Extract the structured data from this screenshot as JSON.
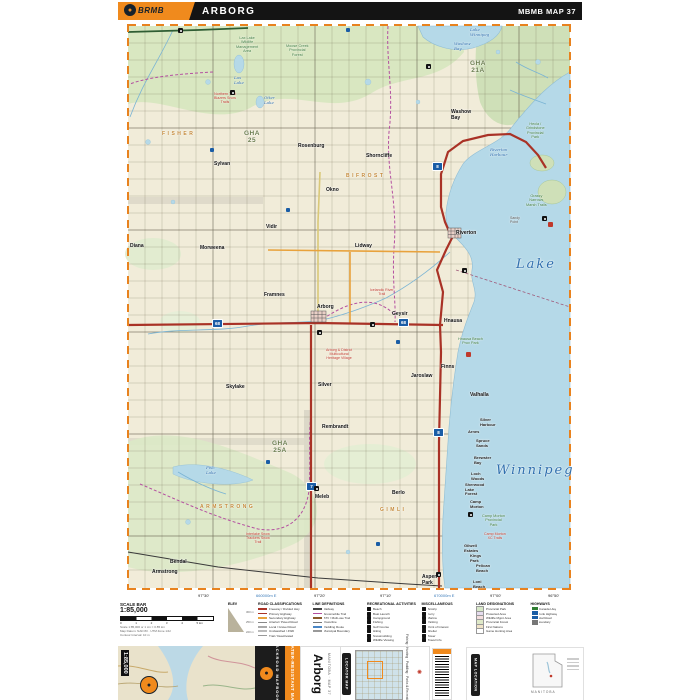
{
  "header": {
    "brand": "BRMB",
    "title": "ARBORG",
    "ref": "MBMB MAP 37"
  },
  "map": {
    "labels": [
      {
        "t": "Sylvan",
        "x": 96,
        "y": 140,
        "c": "town"
      },
      {
        "t": "Rosenburg",
        "x": 180,
        "y": 122,
        "c": "town"
      },
      {
        "t": "Shorncliffe",
        "x": 248,
        "y": 132,
        "c": "town"
      },
      {
        "t": "Okno",
        "x": 208,
        "y": 166,
        "c": "town"
      },
      {
        "t": "Vidir",
        "x": 148,
        "y": 203,
        "c": "town"
      },
      {
        "t": "Lidway",
        "x": 237,
        "y": 222,
        "c": "town"
      },
      {
        "t": "Morweena",
        "x": 82,
        "y": 224,
        "c": "town"
      },
      {
        "t": "Diana",
        "x": 12,
        "y": 222,
        "c": "town"
      },
      {
        "t": "Framnes",
        "x": 146,
        "y": 271,
        "c": "town"
      },
      {
        "t": "Arborg",
        "x": 199,
        "y": 283,
        "c": "town"
      },
      {
        "t": "Geysir",
        "x": 274,
        "y": 290,
        "c": "town"
      },
      {
        "t": "Hnausa",
        "x": 326,
        "y": 297,
        "c": "town"
      },
      {
        "t": "Riverton",
        "x": 338,
        "y": 209,
        "c": "town"
      },
      {
        "t": "Washow\nBay",
        "x": 333,
        "y": 88,
        "c": "town"
      },
      {
        "t": "Finns",
        "x": 323,
        "y": 343,
        "c": "town"
      },
      {
        "t": "Jaroslaw",
        "x": 293,
        "y": 352,
        "c": "town"
      },
      {
        "t": "Valhalla",
        "x": 352,
        "y": 371,
        "c": "town"
      },
      {
        "t": "Skylake",
        "x": 108,
        "y": 363,
        "c": "town"
      },
      {
        "t": "Silver",
        "x": 200,
        "y": 361,
        "c": "town"
      },
      {
        "t": "Rembrandt",
        "x": 204,
        "y": 403,
        "c": "town"
      },
      {
        "t": "Meleb",
        "x": 197,
        "y": 473,
        "c": "town"
      },
      {
        "t": "Berlo",
        "x": 274,
        "y": 469,
        "c": "town"
      },
      {
        "t": "Bendal",
        "x": 52,
        "y": 538,
        "c": "town"
      },
      {
        "t": "Armstrong",
        "x": 34,
        "y": 548,
        "c": "town"
      },
      {
        "t": "Aspen\nPark",
        "x": 304,
        "y": 553,
        "c": "town"
      },
      {
        "t": "Silver\nHarbour",
        "x": 362,
        "y": 396,
        "c": "coast"
      },
      {
        "t": "Arnes",
        "x": 350,
        "y": 408,
        "c": "coast"
      },
      {
        "t": "Spruce\nSands",
        "x": 358,
        "y": 417,
        "c": "coast"
      },
      {
        "t": "Brewster\nBay",
        "x": 356,
        "y": 434,
        "c": "coast"
      },
      {
        "t": "Loch\nWoods",
        "x": 353,
        "y": 450,
        "c": "coast"
      },
      {
        "t": "Sherwood\nLake\nForest",
        "x": 347,
        "y": 461,
        "c": "coast"
      },
      {
        "t": "Camp\nMorton",
        "x": 352,
        "y": 478,
        "c": "coast"
      },
      {
        "t": "Gilwell\nEstates",
        "x": 346,
        "y": 522,
        "c": "coast"
      },
      {
        "t": "Kings\nPark",
        "x": 352,
        "y": 532,
        "c": "coast"
      },
      {
        "t": "Pelican\nBeach",
        "x": 358,
        "y": 542,
        "c": "coast"
      },
      {
        "t": "Loni\nBeach",
        "x": 355,
        "y": 558,
        "c": "coast"
      },
      {
        "t": "Sandy\nPoint",
        "x": 392,
        "y": 194,
        "c": "pt"
      },
      {
        "t": "Lake\nWinnipeg",
        "x": 352,
        "y": 6,
        "c": "water"
      },
      {
        "t": "Washow\nBay",
        "x": 336,
        "y": 20,
        "c": "water"
      },
      {
        "t": "Riverton\nHarbour",
        "x": 372,
        "y": 126,
        "c": "water"
      },
      {
        "t": "Lake",
        "x": 398,
        "y": 236,
        "c": "water-big"
      },
      {
        "t": "Winnipeg",
        "x": 378,
        "y": 442,
        "c": "water-big"
      },
      {
        "t": "Lax\nLake",
        "x": 116,
        "y": 54,
        "c": "water"
      },
      {
        "t": "Otter\nLake",
        "x": 146,
        "y": 74,
        "c": "water"
      },
      {
        "t": "Fish\nLake",
        "x": 88,
        "y": 444,
        "c": "water"
      },
      {
        "t": "Lax Lake\nWildlife\nManagement\nArea",
        "x": 118,
        "y": 14,
        "c": "park"
      },
      {
        "t": "Moose Creek\nProvincial\nForest",
        "x": 168,
        "y": 22,
        "c": "park"
      },
      {
        "t": "Hecla /\nGrindstone\nProvincial\nPark",
        "x": 408,
        "y": 100,
        "c": "park"
      },
      {
        "t": "Grassy\nNarrows\nMarsh Trails",
        "x": 408,
        "y": 172,
        "c": "park"
      },
      {
        "t": "Hnausa Beach\nProv Park",
        "x": 340,
        "y": 315,
        "c": "park"
      },
      {
        "t": "Camp Morton\nProvincial\nPark",
        "x": 364,
        "y": 492,
        "c": "park"
      },
      {
        "t": "GHA\n25",
        "x": 126,
        "y": 108,
        "c": "gha"
      },
      {
        "t": "GHA\n21A",
        "x": 352,
        "y": 38,
        "c": "gha"
      },
      {
        "t": "GHA\n25A",
        "x": 154,
        "y": 418,
        "c": "gha"
      },
      {
        "t": "BIFROST",
        "x": 228,
        "y": 152,
        "c": "muni"
      },
      {
        "t": "ARMSTRONG",
        "x": 82,
        "y": 483,
        "c": "muni"
      },
      {
        "t": "FISHER",
        "x": 44,
        "y": 110,
        "c": "muni"
      },
      {
        "t": "GIMLI",
        "x": 262,
        "y": 486,
        "c": "muni"
      },
      {
        "t": "Northern Trail\nBlazers Snow\nTrails",
        "x": 96,
        "y": 70,
        "c": "trail"
      },
      {
        "t": "Icelandic River\nTrail",
        "x": 252,
        "y": 266,
        "c": "trail"
      },
      {
        "t": "Arborg & District\nMulticultural\nHeritage Village",
        "x": 208,
        "y": 326,
        "c": "trail"
      },
      {
        "t": "Interlake Snow\nTrackers Snow\nTrail",
        "x": 128,
        "y": 510,
        "c": "trail"
      },
      {
        "t": "Camp Morton\nXC Trails",
        "x": 366,
        "y": 510,
        "c": "trail"
      }
    ],
    "shields": [
      {
        "n": "68",
        "x": 94,
        "y": 297
      },
      {
        "n": "68",
        "x": 280,
        "y": 296
      },
      {
        "n": "7",
        "x": 188,
        "y": 460
      },
      {
        "n": "8",
        "x": 314,
        "y": 140
      },
      {
        "n": "8",
        "x": 315,
        "y": 406
      }
    ],
    "markers": [
      {
        "x": 60,
        "y": 6,
        "k": "poi"
      },
      {
        "x": 112,
        "y": 68,
        "k": "poi"
      },
      {
        "x": 308,
        "y": 42,
        "k": "poi"
      },
      {
        "x": 344,
        "y": 246,
        "k": "poi"
      },
      {
        "x": 199,
        "y": 308,
        "k": "poi"
      },
      {
        "x": 350,
        "y": 490,
        "k": "poi"
      },
      {
        "x": 424,
        "y": 194,
        "k": "poi"
      },
      {
        "x": 196,
        "y": 464,
        "k": "poi"
      },
      {
        "x": 318,
        "y": 550,
        "k": "poi"
      },
      {
        "x": 252,
        "y": 300,
        "k": "poi"
      },
      {
        "x": 92,
        "y": 126,
        "k": "trl"
      },
      {
        "x": 168,
        "y": 186,
        "k": "trl"
      },
      {
        "x": 148,
        "y": 438,
        "k": "trl"
      },
      {
        "x": 278,
        "y": 318,
        "k": "trl"
      },
      {
        "x": 258,
        "y": 520,
        "k": "trl"
      },
      {
        "x": 228,
        "y": 6,
        "k": "trl"
      },
      {
        "x": 430,
        "y": 200,
        "k": "red"
      },
      {
        "x": 348,
        "y": 330,
        "k": "red"
      }
    ],
    "margin": {
      "top": [
        {
          "t": "97°30'",
          "x": 80
        },
        {
          "t": "660000m E",
          "x": 138,
          "b": 1
        },
        {
          "t": "97°20'",
          "x": 196
        },
        {
          "t": "97°10'",
          "x": 262
        },
        {
          "t": "670000m E",
          "x": 316,
          "b": 1
        },
        {
          "t": "97°00'",
          "x": 372
        },
        {
          "t": "96°50'",
          "x": 430
        }
      ],
      "bottom": [
        {
          "t": "97°30'",
          "x": 80
        },
        {
          "t": "660000m E",
          "x": 138,
          "b": 1
        },
        {
          "t": "97°20'",
          "x": 196
        },
        {
          "t": "97°10'",
          "x": 262
        },
        {
          "t": "670000m E",
          "x": 316,
          "b": 1
        },
        {
          "t": "97°00'",
          "x": 372
        },
        {
          "t": "96°50'",
          "x": 430
        }
      ],
      "left": [
        {
          "t": "51°15'",
          "y": 82
        },
        {
          "t": "5680000m N",
          "y": 170,
          "b": 1
        },
        {
          "t": "51°10'",
          "y": 250
        },
        {
          "t": "51°05'",
          "y": 330
        },
        {
          "t": "5665000m N",
          "y": 418,
          "b": 1
        },
        {
          "t": "51°00'",
          "y": 478
        },
        {
          "t": "50°55'",
          "y": 550
        }
      ],
      "right": [
        {
          "t": "51°15'",
          "y": 82
        },
        {
          "t": "5680000m N",
          "y": 170,
          "b": 1
        },
        {
          "t": "51°10'",
          "y": 250
        },
        {
          "t": "51°05'",
          "y": 330
        },
        {
          "t": "5665000m N",
          "y": 418,
          "b": 1
        },
        {
          "t": "51°00'",
          "y": 478
        },
        {
          "t": "50°55'",
          "y": 550
        }
      ]
    }
  },
  "legend": {
    "scale": {
      "title": "SCALE BAR",
      "ratio": "1:85,000",
      "km": [
        "0",
        "1",
        "2",
        "3",
        "4",
        "5 km"
      ],
      "fine": [
        "Scale 1:85,000 or 1 cm = 0.85 km",
        "Map Datum: NAD 83 · UTM Zone 14U",
        "Contour Interval: 10 m"
      ]
    },
    "elevation": {
      "title": "ELEV",
      "labels": [
        "300 m",
        "250 m",
        "220 m"
      ]
    },
    "columns": [
      {
        "title": "ROAD CLASSIFICATIONS",
        "kind": "line",
        "items": [
          {
            "t": "Freeway / Divided Hwy",
            "c": "#a93226"
          },
          {
            "t": "Primary Highway",
            "c": "#a93226"
          },
          {
            "t": "Secondary Highway",
            "c": "#e8a23c"
          },
          {
            "t": "Arterial / Paved Road",
            "c": "#888888"
          },
          {
            "t": "Local / Gravel Road",
            "c": "#aaaaaa"
          },
          {
            "t": "Unclassified / 4WD",
            "c": "#bbbbbb"
          },
          {
            "t": "Trail / Deactivated",
            "c": "#999999"
          }
        ]
      },
      {
        "title": "LINE DEFINITIONS",
        "kind": "line",
        "items": [
          {
            "t": "Railway",
            "c": "#444444"
          },
          {
            "t": "Snowmobile Trail",
            "c": "#b44fa0"
          },
          {
            "t": "ATV / Multi-use Trail",
            "c": "#8a5a2b"
          },
          {
            "t": "Powerline",
            "c": "#777777"
          },
          {
            "t": "Paddling Route",
            "c": "#4a86c5"
          },
          {
            "t": "Municipal Boundary",
            "c": "#999999"
          }
        ]
      },
      {
        "title": "RECREATIONAL ACTIVITIES",
        "kind": "icon",
        "items": [
          {
            "t": "Beach"
          },
          {
            "t": "Boat Launch"
          },
          {
            "t": "Campground"
          },
          {
            "t": "Fishing"
          },
          {
            "t": "Golf Course"
          },
          {
            "t": "Hiking"
          },
          {
            "t": "Snowmobiling"
          },
          {
            "t": "Wildlife Viewing"
          }
        ]
      },
      {
        "title": "MISCELLANEOUS",
        "kind": "icon",
        "items": [
          {
            "t": "Airstrip"
          },
          {
            "t": "Ferry"
          },
          {
            "t": "Marina"
          },
          {
            "t": "Parking"
          },
          {
            "t": "Point of Interest"
          },
          {
            "t": "Shelter"
          },
          {
            "t": "Tower"
          },
          {
            "t": "Travel Info"
          }
        ]
      },
      {
        "title": "LAND DESIGNATIONS",
        "kind": "swatch",
        "items": [
          {
            "t": "Provincial Park",
            "c": "#d8e8c8"
          },
          {
            "t": "Protected Area",
            "c": "#e6dcee"
          },
          {
            "t": "Wildlife Mgmt Area",
            "c": "#f4dede"
          },
          {
            "t": "Provincial Forest",
            "c": "#dfe9c8"
          },
          {
            "t": "First Nations",
            "c": "#f0e4c8"
          },
          {
            "t": "Game Hunting Area",
            "c": "#ffffff"
          }
        ]
      },
      {
        "title": "HIGHWAYS",
        "kind": "shield",
        "items": [
          {
            "t": "Trans-Canada Hwy",
            "c": "#2e7d32"
          },
          {
            "t": "Prov Trunk Highway",
            "c": "#1a5da6"
          },
          {
            "t": "Provincial Road",
            "c": "#1a5da6"
          },
          {
            "t": "GHA Boundary",
            "c": "#777777"
          }
        ]
      }
    ]
  },
  "footer": {
    "scale_chip": "1:85,000",
    "brand": "BACKROAD MAPBOOKS",
    "strip": "WATER-RESISTANT MAP",
    "title": "Arborg",
    "subtitle": "MANITOBA · MAP 37",
    "locator_tab": "LOCATOR MAP",
    "features": "Fishing · Hunting · Paddling · Parks & Recreation · Trails",
    "location_tab": "MAP LOCATION",
    "province": "MANITOBA"
  }
}
